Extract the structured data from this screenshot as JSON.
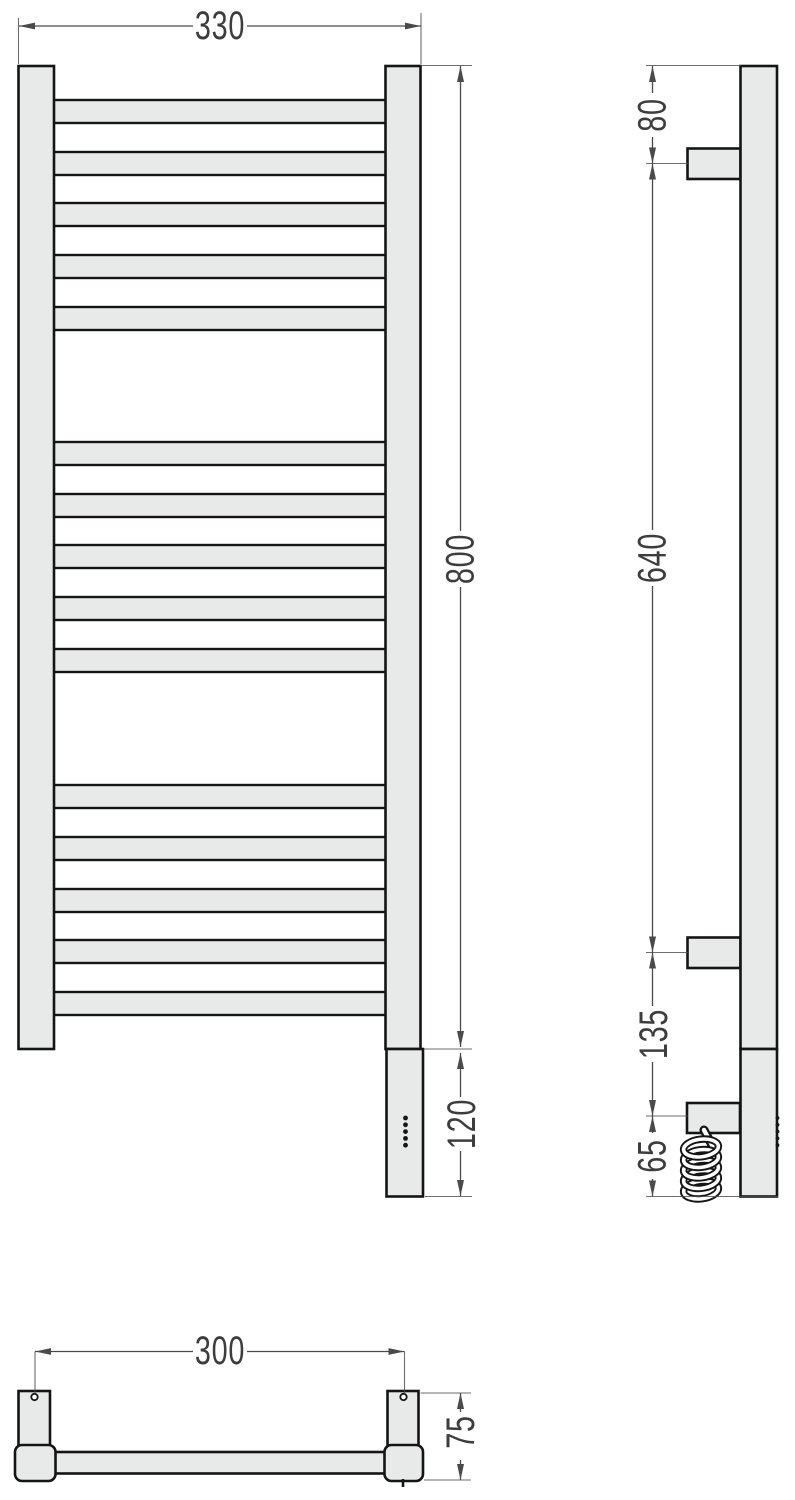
{
  "drawing": {
    "kind": "technical-drawing",
    "subject": "ladder towel radiator with electric heating element, three orthographic views",
    "units": "mm"
  },
  "colors": {
    "background": "#ffffff",
    "part_fill": "#e8e9e9",
    "part_outline": "#151515",
    "dim_line": "#4a4a4a",
    "dim_text": "#3d3d3d"
  },
  "labels": {
    "front_width": "330",
    "front_height": "800",
    "heater_height": "120",
    "side_top_offset": "80",
    "side_bracket_span": "640",
    "side_bracket_to_cable": "135",
    "side_cable_to_bottom": "65",
    "plan_mount_span": "300",
    "plan_depth": "75"
  },
  "geometry": {
    "front": {
      "rung_tops": [
        100,
        152,
        203,
        255,
        307,
        442,
        494,
        545,
        597,
        649,
        785,
        837,
        889,
        940,
        992
      ],
      "rung": {
        "x": 51,
        "width": 337,
        "height": 23
      },
      "led_dots": {
        "cx": 405.5,
        "first_cy": 1118,
        "step": 6.8,
        "count": 5,
        "r": 2.4
      }
    },
    "side": {
      "led_dots": {
        "cx": 777.5,
        "first_cy": 1118,
        "step": 6.8,
        "count": 5,
        "r": 1.9
      },
      "coil": {
        "cx": 701,
        "rx": 17.5,
        "ry": 8.8,
        "tilt": -7,
        "loop_cys": [
          1190,
          1179.5,
          1169,
          1158.5,
          1148
        ],
        "strand": {
          "x1": 704,
          "y1": 1130,
          "x2": 713,
          "y2": 1147
        }
      }
    }
  }
}
